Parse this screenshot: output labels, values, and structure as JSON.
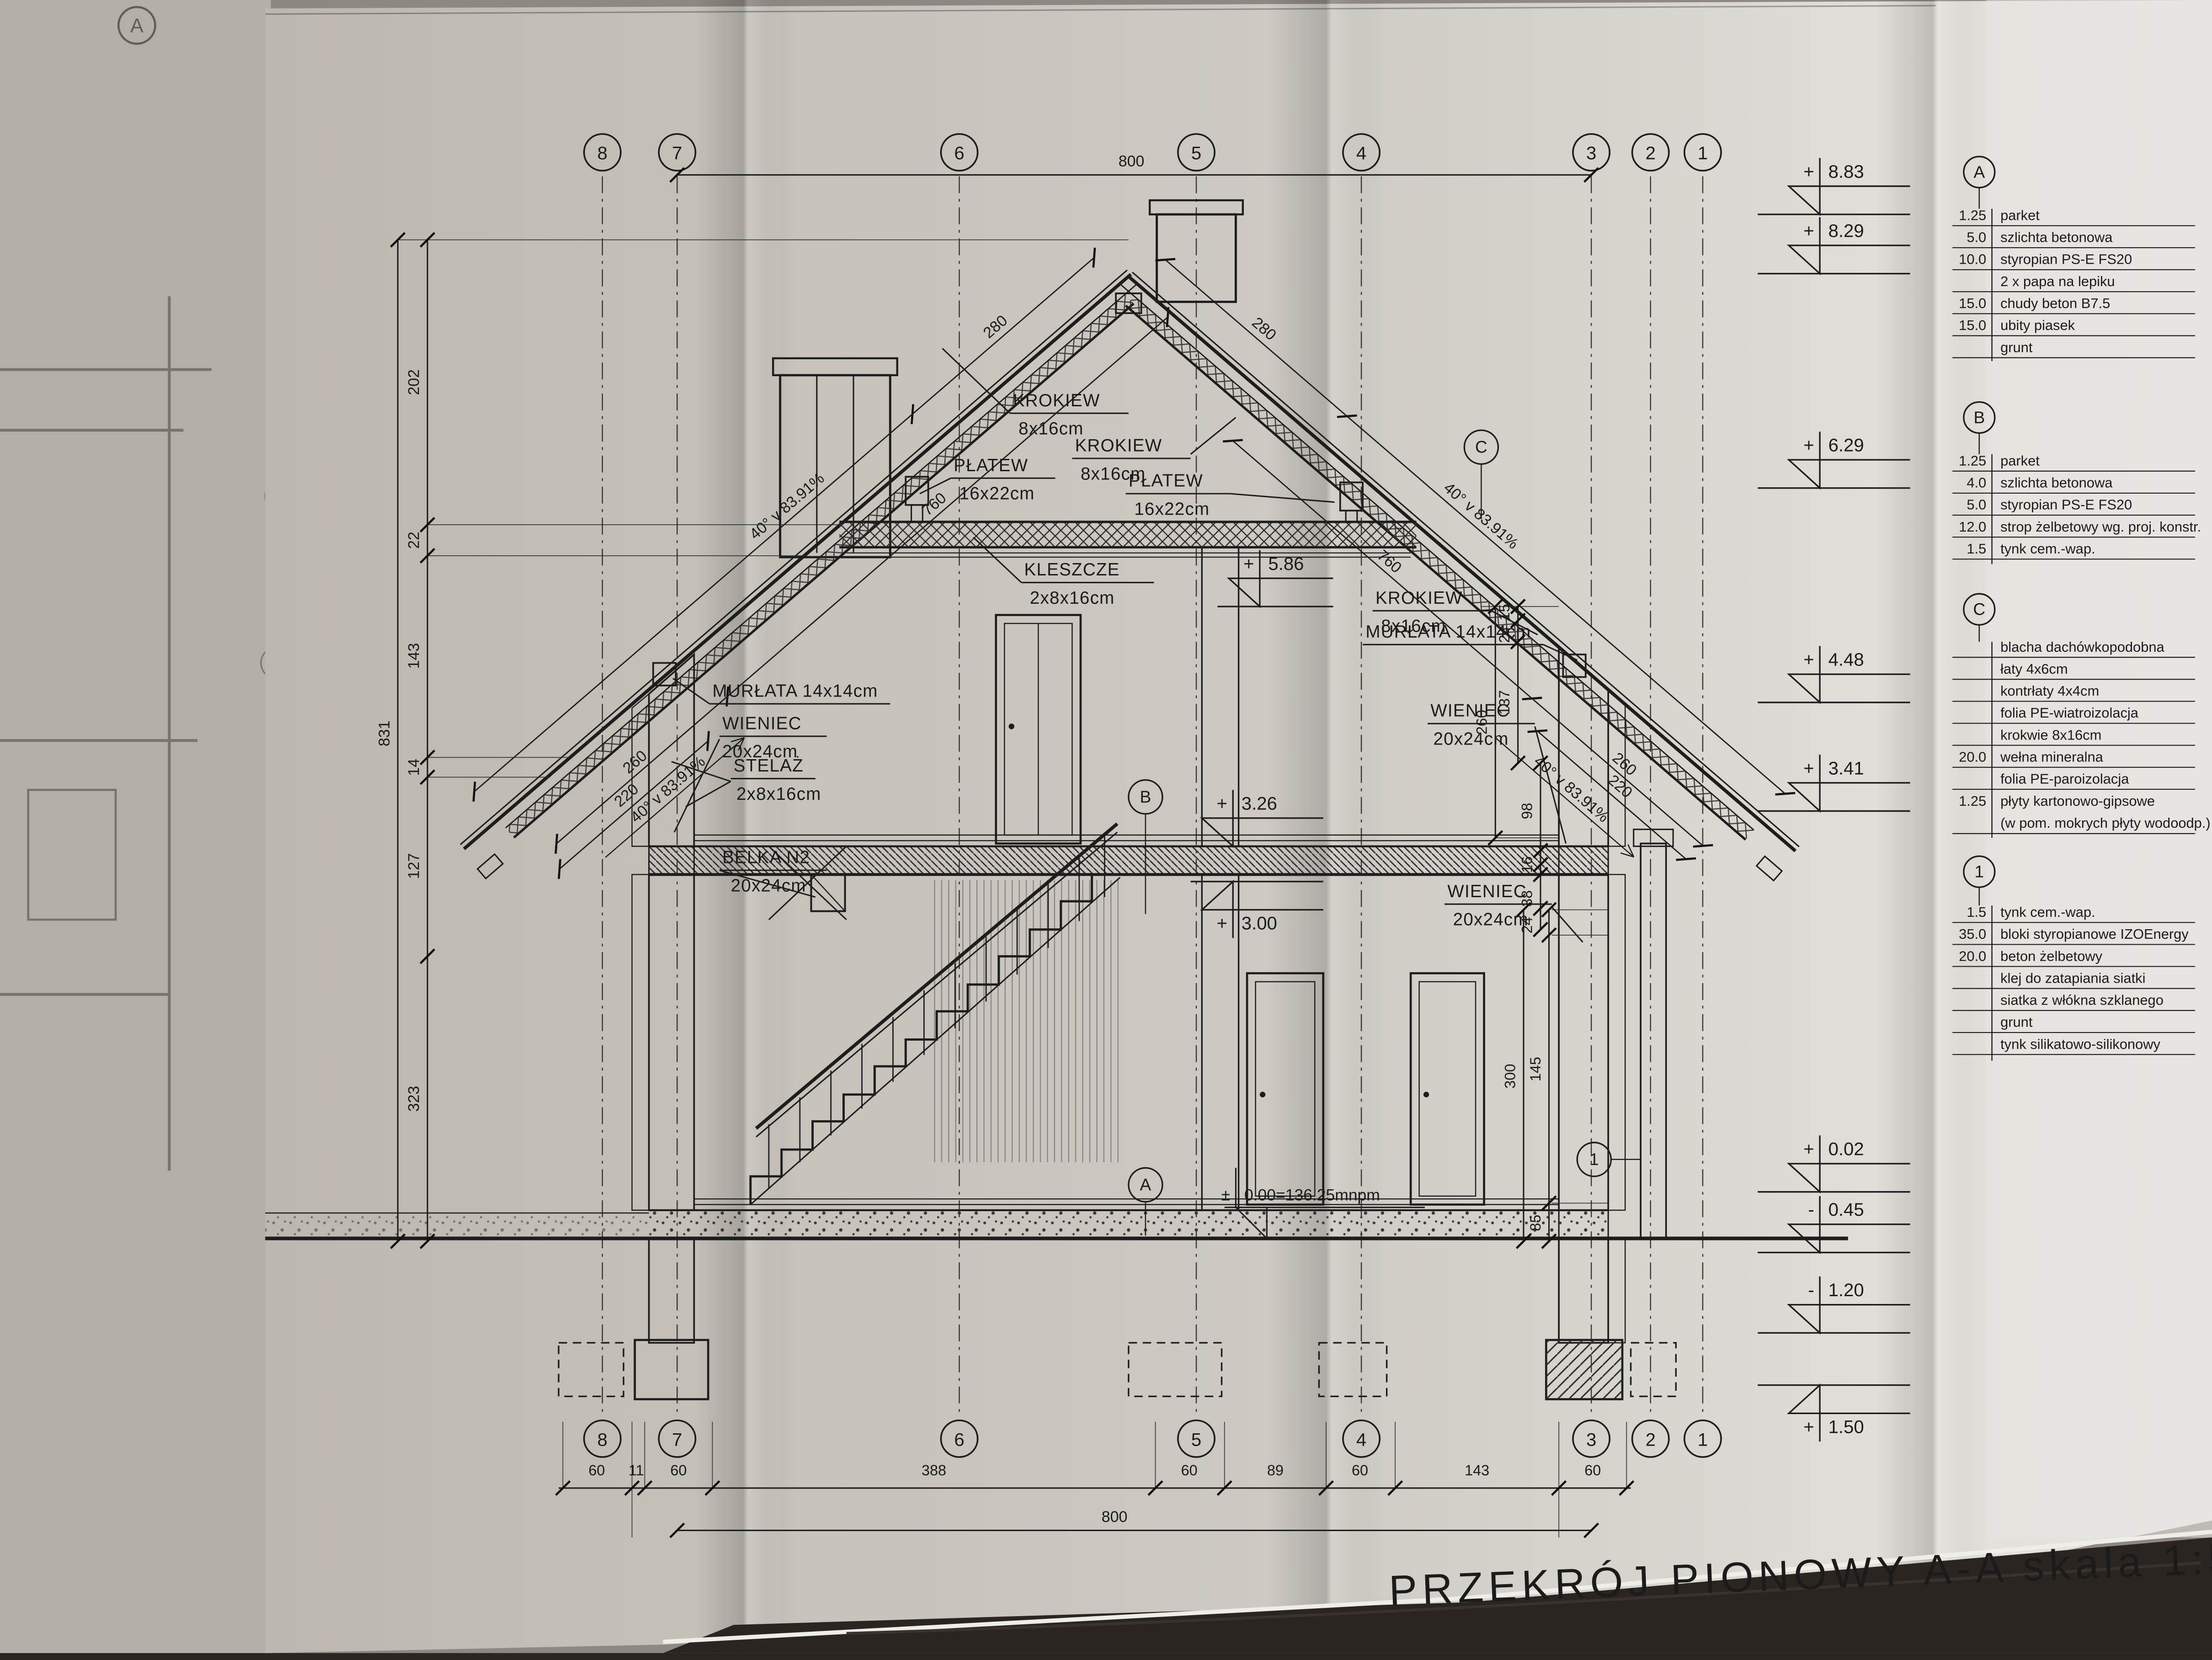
{
  "title": "PRZEKRÓJ PIONOWY A-A skala 1:50",
  "axes": [
    "8",
    "7",
    "6",
    "5",
    "4",
    "3",
    "2",
    "1"
  ],
  "sections": {
    "a": "A",
    "b": "B",
    "c": "C",
    "one": "1"
  },
  "legend_a": {
    "id": "A",
    "rows": [
      [
        "1.25",
        "parket"
      ],
      [
        "5.0",
        "szlichta betonowa"
      ],
      [
        "10.0",
        "styropian PS-E FS20"
      ],
      [
        "",
        "2 x papa na lepiku"
      ],
      [
        "15.0",
        "chudy beton B7.5"
      ],
      [
        "15.0",
        "ubity piasek"
      ],
      [
        "",
        "grunt"
      ]
    ]
  },
  "legend_b": {
    "id": "B",
    "rows": [
      [
        "1.25",
        "parket"
      ],
      [
        "4.0",
        "szlichta betonowa"
      ],
      [
        "5.0",
        "styropian PS-E FS20"
      ],
      [
        "12.0",
        "strop żelbetowy wg. proj. konstr."
      ],
      [
        "1.5",
        "tynk cem.-wap."
      ]
    ]
  },
  "legend_c": {
    "id": "C",
    "rows": [
      [
        "",
        "blacha dachówkopodobna"
      ],
      [
        "",
        "łaty 4x6cm"
      ],
      [
        "",
        "kontrłaty 4x4cm"
      ],
      [
        "",
        "folia PE-wiatroizolacja"
      ],
      [
        "",
        "krokwie 8x16cm"
      ],
      [
        "20.0",
        "wełna mineralna"
      ],
      [
        "",
        "folia PE-paroizolacja"
      ],
      [
        "1.25",
        "płyty kartonowo-gipsowe"
      ],
      [
        "",
        "(w pom. mokrych płyty wodoodp.)"
      ]
    ]
  },
  "legend_1": {
    "id": "1",
    "rows": [
      [
        "1.5",
        "tynk cem.-wap."
      ],
      [
        "35.0",
        "bloki styropianowe IZOEnergy"
      ],
      [
        "20.0",
        "beton żelbetowy"
      ],
      [
        "",
        "klej do zatapiania siatki"
      ],
      [
        "",
        "siatka z włókna szklanego"
      ],
      [
        "",
        "grunt"
      ],
      [
        "",
        "tynk silikatowo-silikonowy"
      ]
    ]
  },
  "levels": {
    "p883": {
      "s": "+",
      "v": "8.83"
    },
    "p829": {
      "s": "+",
      "v": "8.29"
    },
    "p629": {
      "s": "+",
      "v": "6.29"
    },
    "p448": {
      "s": "+",
      "v": "4.48"
    },
    "p341": {
      "s": "+",
      "v": "3.41"
    },
    "p586": {
      "s": "+",
      "v": "5.86"
    },
    "p326": {
      "s": "+",
      "v": "3.26"
    },
    "p300": {
      "s": "+",
      "v": "3.00"
    },
    "p002": {
      "s": "+",
      "v": "0.02"
    },
    "m045": {
      "s": "-",
      "v": "0.45"
    },
    "m120": {
      "s": "-",
      "v": "1.20"
    },
    "p150": {
      "s": "+",
      "v": "1.50"
    },
    "zero": {
      "s": "±",
      "v": "0.00=136.25mnpm"
    }
  },
  "members": {
    "krokiew": {
      "n": "KROKIEW",
      "d": "8x16cm"
    },
    "platew": {
      "n": "PŁATEW",
      "d": "16x22cm"
    },
    "kleszcze": {
      "n": "KLESZCZE",
      "d": "2x8x16cm"
    },
    "murlata": "MURŁATA 14x14cm",
    "wieniec": {
      "n": "WIENIEC",
      "d": "20x24cm"
    },
    "stelaz": {
      "n": "STELAŻ",
      "d": "2x8x16cm"
    },
    "belka": {
      "n": "BELKA N2",
      "d": "20x24cm"
    }
  },
  "dims": {
    "top_total": "800",
    "bottom_total": "800",
    "bottom": [
      "60",
      "11",
      "60",
      "388",
      "60",
      "89",
      "60",
      "143",
      "60"
    ],
    "left_outer": "831",
    "left": [
      "202",
      "22",
      "143",
      "14",
      "127",
      "323"
    ],
    "roof_len": "280",
    "slope": "40° v 83.91%",
    "roof_760": "760",
    "roof_260": "260",
    "roof_220": "220",
    "w260": "260",
    "w15": "15",
    "w24": "24",
    "w137": "137",
    "w98": "98",
    "w16": "16",
    "w38": "38",
    "w24b": "24",
    "w300": "300",
    "w145": "145",
    "w85": "85"
  }
}
